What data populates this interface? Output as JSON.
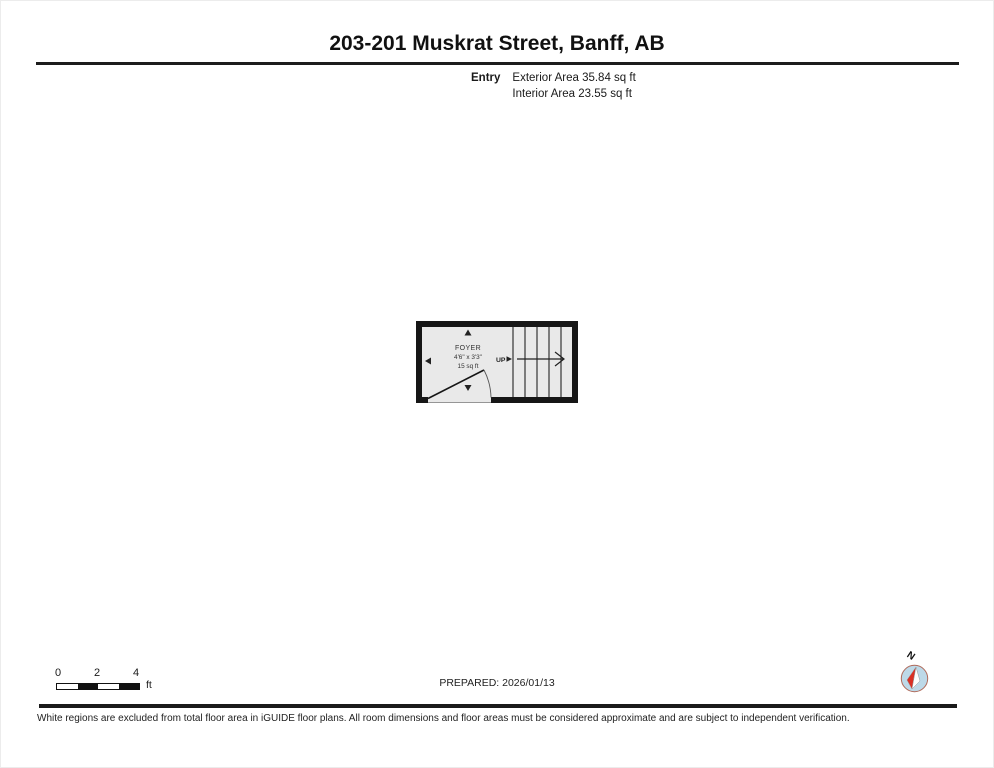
{
  "page": {
    "title": "203-201 Muskrat Street, Banff, AB",
    "prepared": "PREPARED: 2026/01/13",
    "disclaimer": "White regions are excluded from total floor area in iGUIDE floor plans. All room dimensions and floor areas must be considered approximate and are subject to independent verification."
  },
  "legend": {
    "floor_label": "Entry",
    "exterior_area": "Exterior Area 35.84 sq ft",
    "interior_area": "Interior Area 23.55 sq ft"
  },
  "floor_plan": {
    "room": {
      "name": "FOYER",
      "dimensions": "4'6\" x 3'3\"",
      "area": "15 sq ft"
    },
    "stairs_label": "UP",
    "wall_color": "#161616",
    "floor_color": "#e9e9e9"
  },
  "scale_bar": {
    "ticks": [
      "0",
      "2",
      "4"
    ],
    "unit": "ft"
  },
  "compass": {
    "north_label": "N",
    "needle_red": "#d93025",
    "circle_fill": "#bdd9e8"
  }
}
